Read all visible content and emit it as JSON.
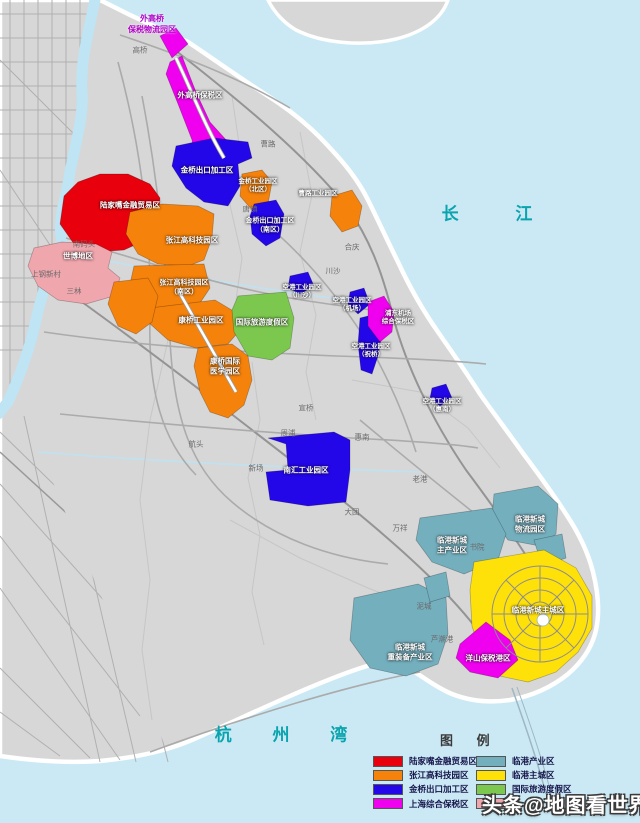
{
  "watermark": {
    "text": "头条@地图看世界"
  },
  "legend": {
    "title": "图 例",
    "columns": [
      {
        "items": [
          {
            "color": "#e8000d",
            "label": "陆家嘴金融贸易区"
          },
          {
            "color": "#f5820b",
            "label": "张江高科技园区"
          },
          {
            "color": "#2407e8",
            "label": "金桥出口加工区"
          },
          {
            "color": "#ef00ef",
            "label": "上海综合保税区"
          }
        ]
      },
      {
        "items": [
          {
            "color": "#74afbe",
            "label": "临港产业区"
          },
          {
            "color": "#ffe10a",
            "label": "临港主城区"
          },
          {
            "color": "#7cc84f",
            "label": "国际旅游度假区"
          },
          {
            "color": "#f0a6ad",
            "label": ""
          }
        ]
      }
    ]
  },
  "water_labels": [
    {
      "text": "长 江",
      "x": 500,
      "y": 214,
      "ls": 26
    },
    {
      "text": "杭 州 湾",
      "x": 290,
      "y": 735,
      "ls": 18
    }
  ],
  "zone_labels": [
    {
      "t": "外高桥",
      "x": 152,
      "y": 19,
      "cls": "purple"
    },
    {
      "t": "保税物流园区",
      "x": 152,
      "y": 30,
      "cls": "purple"
    },
    {
      "t": "外高桥保税区",
      "x": 200,
      "y": 95
    },
    {
      "t": "陆家嘴金融贸易区",
      "x": 130,
      "y": 205
    },
    {
      "t": "金桥出口加工区",
      "x": 207,
      "y": 170
    },
    {
      "t": "金桥工业园区",
      "x": 258,
      "y": 182,
      "fs": 6.5
    },
    {
      "t": "（北区）",
      "x": 258,
      "y": 190,
      "fs": 6.5
    },
    {
      "t": "曹路工业园区",
      "x": 318,
      "y": 194,
      "fs": 6.5
    },
    {
      "t": "金桥出口加工区",
      "x": 270,
      "y": 221,
      "fs": 7
    },
    {
      "t": "（南区）",
      "x": 270,
      "y": 230,
      "fs": 7
    },
    {
      "t": "张江高科技园区",
      "x": 192,
      "y": 240
    },
    {
      "t": "张江高科技园区",
      "x": 184,
      "y": 283,
      "fs": 7
    },
    {
      "t": "（南区）",
      "x": 184,
      "y": 292,
      "fs": 7
    },
    {
      "t": "空港工业园区",
      "x": 302,
      "y": 288,
      "fs": 6.5
    },
    {
      "t": "（川沙）",
      "x": 302,
      "y": 296,
      "fs": 6.5
    },
    {
      "t": "空港工业园区",
      "x": 352,
      "y": 301,
      "fs": 6.5
    },
    {
      "t": "（机场）",
      "x": 352,
      "y": 309,
      "fs": 6.5
    },
    {
      "t": "浦东机场",
      "x": 398,
      "y": 314,
      "fs": 6.5
    },
    {
      "t": "综合保税区",
      "x": 398,
      "y": 322,
      "fs": 6.5
    },
    {
      "t": "国际旅游度假区",
      "x": 262,
      "y": 322
    },
    {
      "t": "康桥工业园区",
      "x": 201,
      "y": 320
    },
    {
      "t": "空港工业园区",
      "x": 371,
      "y": 347,
      "fs": 6.5
    },
    {
      "t": "（祝桥）",
      "x": 371,
      "y": 355,
      "fs": 6.5
    },
    {
      "t": "康桥国际",
      "x": 225,
      "y": 361
    },
    {
      "t": "医学园区",
      "x": 225,
      "y": 371
    },
    {
      "t": "空港工业园区",
      "x": 442,
      "y": 402,
      "fs": 6.5
    },
    {
      "t": "（惠南）",
      "x": 442,
      "y": 410,
      "fs": 6.5
    },
    {
      "t": "南汇工业园区",
      "x": 306,
      "y": 470
    },
    {
      "t": "临港新城",
      "x": 530,
      "y": 519
    },
    {
      "t": "物流园区",
      "x": 530,
      "y": 529
    },
    {
      "t": "临港新城",
      "x": 452,
      "y": 540
    },
    {
      "t": "主产业区",
      "x": 452,
      "y": 550
    },
    {
      "t": "临港新城主城区",
      "x": 538,
      "y": 610
    },
    {
      "t": "临港新城",
      "x": 410,
      "y": 647
    },
    {
      "t": "重装备产业区",
      "x": 410,
      "y": 657
    },
    {
      "t": "洋山保税港区",
      "x": 488,
      "y": 658
    },
    {
      "t": "世博地区",
      "x": 78,
      "y": 256
    }
  ],
  "town_labels": [
    {
      "t": "高桥",
      "x": 140,
      "y": 50
    },
    {
      "t": "曹路",
      "x": 268,
      "y": 144
    },
    {
      "t": "唐镇",
      "x": 250,
      "y": 209
    },
    {
      "t": "合庆",
      "x": 352,
      "y": 247
    },
    {
      "t": "川沙",
      "x": 333,
      "y": 271
    },
    {
      "t": "南码头",
      "x": 84,
      "y": 244
    },
    {
      "t": "上钢新村",
      "x": 46,
      "y": 274
    },
    {
      "t": "三林",
      "x": 74,
      "y": 291
    },
    {
      "t": "宣桥",
      "x": 306,
      "y": 408
    },
    {
      "t": "周浦",
      "x": 288,
      "y": 433
    },
    {
      "t": "惠南",
      "x": 362,
      "y": 437
    },
    {
      "t": "航头",
      "x": 196,
      "y": 444
    },
    {
      "t": "新场",
      "x": 256,
      "y": 468
    },
    {
      "t": "老港",
      "x": 420,
      "y": 479
    },
    {
      "t": "大团",
      "x": 352,
      "y": 512
    },
    {
      "t": "万祥",
      "x": 400,
      "y": 528
    },
    {
      "t": "书院",
      "x": 477,
      "y": 547
    },
    {
      "t": "泥城",
      "x": 424,
      "y": 606
    },
    {
      "t": "芦潮港",
      "x": 442,
      "y": 639
    }
  ],
  "colors": {
    "water": "#cbe9f5",
    "land": "#d7d7d7",
    "red": "#e8000d",
    "orange": "#f5820b",
    "blue": "#2407e8",
    "magenta": "#ef00ef",
    "pink": "#f0a6ad",
    "teal": "#74afbe",
    "yellow": "#ffe10a",
    "green": "#7cc84f",
    "water_text": "#0aa4ae"
  }
}
